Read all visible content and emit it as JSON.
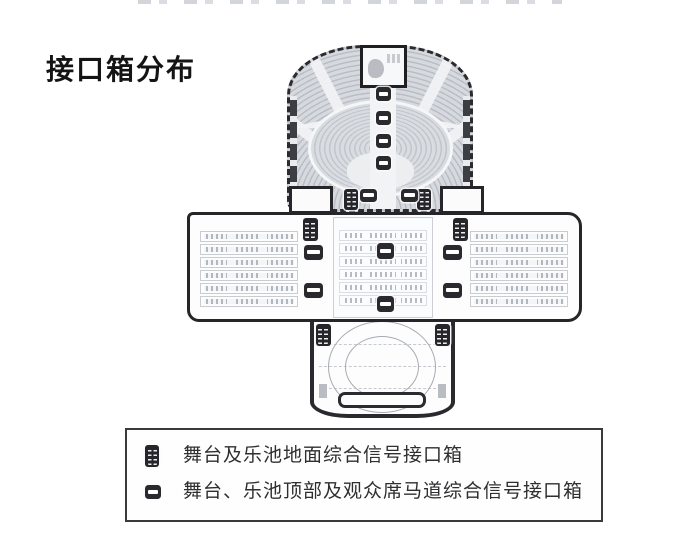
{
  "title": "接口箱分布",
  "legend": {
    "items": [
      {
        "icon": "floor-interface-box-icon",
        "label": "舞台及乐池地面综合信号接口箱"
      },
      {
        "icon": "overhead-interface-box-icon",
        "label": "舞台、乐池顶部及观众席马道综合信号接口箱"
      }
    ]
  },
  "colors": {
    "wall": "#26262a",
    "seating_gray": "#ccd0d6",
    "box_dark": "#2a2a2e",
    "background": "#ffffff"
  },
  "plan": {
    "wing_rows_per_side": 6,
    "interface_boxes": {
      "floor": [
        [
          351,
          199,
          14,
          21
        ],
        [
          424,
          199,
          14,
          21
        ],
        [
          310,
          229,
          15,
          23
        ],
        [
          460,
          229,
          15,
          23
        ],
        [
          323,
          335,
          15,
          22
        ],
        [
          442,
          335,
          15,
          22
        ]
      ],
      "overhead": [
        [
          383,
          94,
          15,
          14
        ],
        [
          383,
          118,
          15,
          14
        ],
        [
          383,
          141,
          15,
          14
        ],
        [
          383,
          163,
          15,
          14
        ],
        [
          368,
          195,
          17,
          13
        ],
        [
          409,
          195,
          17,
          13
        ],
        [
          313,
          252,
          19,
          15
        ],
        [
          385,
          251,
          17,
          16
        ],
        [
          452,
          252,
          19,
          15
        ],
        [
          313,
          290,
          19,
          15
        ],
        [
          452,
          290,
          19,
          15
        ],
        [
          385,
          304,
          17,
          16
        ]
      ]
    }
  }
}
